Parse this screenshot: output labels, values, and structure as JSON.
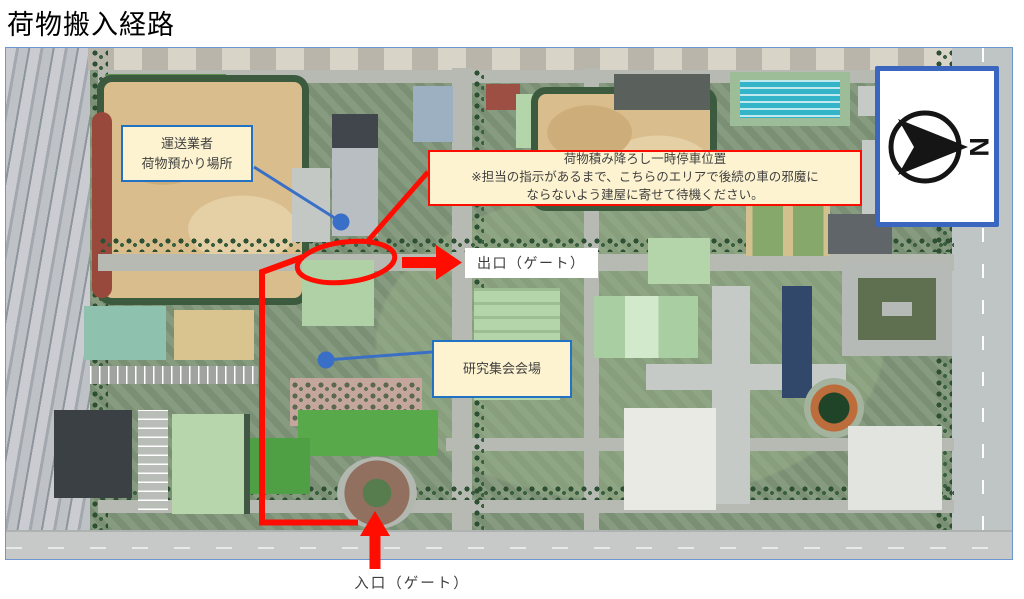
{
  "title": "荷物搬入経路",
  "notes": {
    "storage": {
      "line1": "運送業者",
      "line2": "荷物預かり場所"
    },
    "parking": {
      "line1": "荷物積み降ろし一時停車位置",
      "line2": "※担当の指示があるまで、こちらのエリアで後続の車の邪魔に",
      "line3": "ならないよう建屋に寄せて待機ください。"
    }
  },
  "labels": {
    "exit": "出口（ゲート）",
    "venue": "研究集会会場",
    "entrance": "入口（ゲート）"
  },
  "compass": {
    "letter": "N"
  },
  "colors": {
    "route_red": "#FE0D00",
    "annotation_blue": "#2272C3",
    "connector_blue": "#3A6FC7",
    "note_bg": "#FDF3D0",
    "note_text": "#3F3F3F",
    "compass_border": "#3A66C0"
  }
}
